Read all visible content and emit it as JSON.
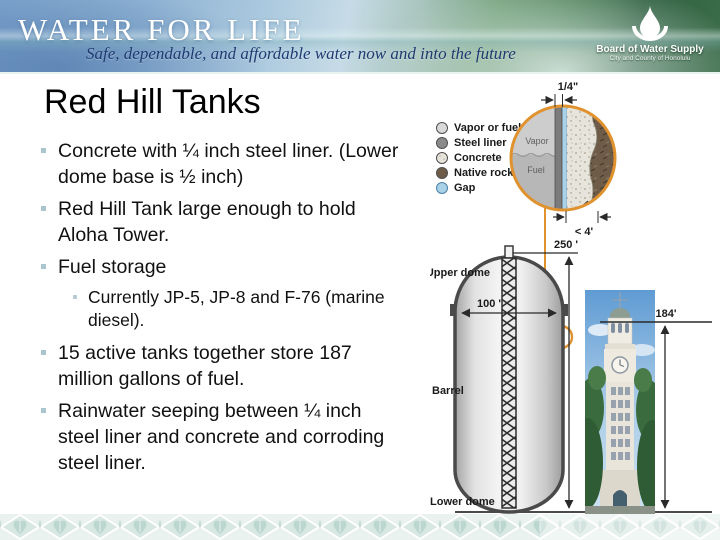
{
  "header": {
    "brand": "WATER FOR LIFE",
    "tagline": "Safe, dependable, and affordable water now and into the future",
    "logo_line1": "Board of Water Supply",
    "logo_line2": "City and County of Honolulu"
  },
  "slide": {
    "title": "Red Hill Tanks",
    "bullets": [
      {
        "level": 1,
        "text": "Concrete with ¼ inch steel liner. (Lower dome base is ½ inch)"
      },
      {
        "level": 1,
        "text": "Red Hill Tank large enough to hold Aloha Tower."
      },
      {
        "level": 1,
        "text": "Fuel storage"
      },
      {
        "level": 2,
        "text": "Currently JP-5, JP-8 and F-76 (marine diesel)."
      },
      {
        "level": 1,
        "text": "15 active tanks together store 187 million gallons of fuel."
      },
      {
        "level": 1,
        "text": "Rainwater seeping between ¼ inch steel liner and concrete and corroding steel liner."
      }
    ]
  },
  "diagram": {
    "legend": [
      {
        "label": "Vapor or fuel",
        "color": "#d9d9d9"
      },
      {
        "label": "Steel liner",
        "color": "#8a8a8a"
      },
      {
        "label": "Concrete",
        "color": "#e6e3da"
      },
      {
        "label": "Native rock",
        "color": "#6e5c49"
      },
      {
        "label": "Gap",
        "color": "#a9d2e8"
      }
    ],
    "callout": {
      "liner_width": "1/4\"",
      "vapor": "Vapor",
      "fuel": "Fuel",
      "concrete_width": "< 4'"
    },
    "tank": {
      "height_label": "250 '",
      "diameter_label": "100 '",
      "upper_dome": "Upper dome",
      "barrel": "Barrel",
      "lower_dome": "Lower dome"
    },
    "tower_height_label": "184'",
    "accent_orange": "#e0922e"
  }
}
